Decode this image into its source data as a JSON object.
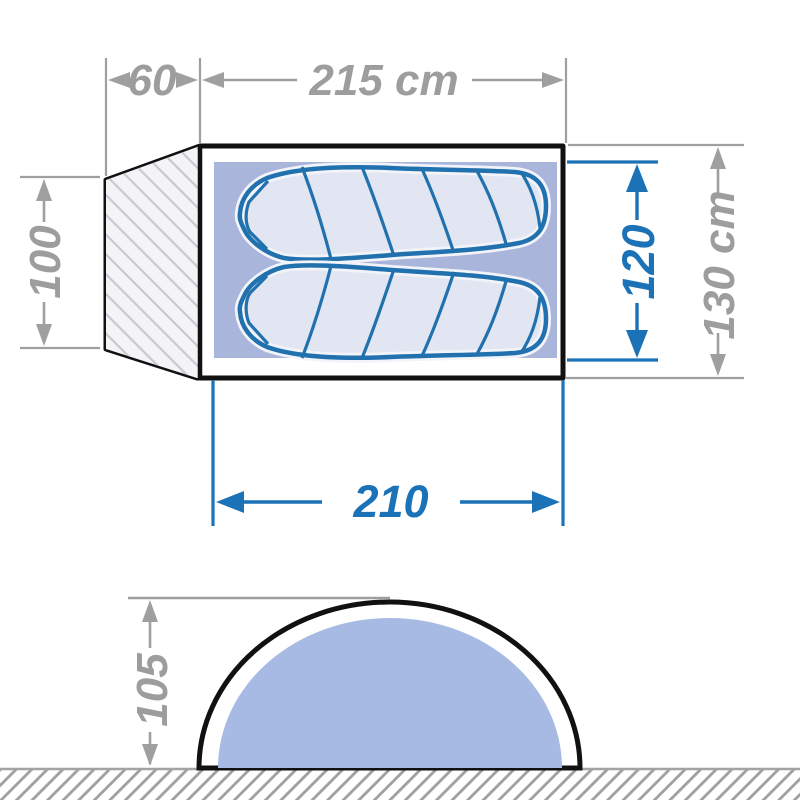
{
  "diagram": {
    "dimensions": {
      "porch_depth": {
        "label": "60"
      },
      "inner_length": {
        "label": "215 cm"
      },
      "porch_width": {
        "label": "100"
      },
      "inner_width": {
        "label": "120"
      },
      "outer_width": {
        "label": "130 cm"
      },
      "bedroom_length": {
        "label": "210"
      },
      "height": {
        "label": "105"
      }
    },
    "colors": {
      "dimension_gray": "#9d9d9d",
      "dimension_blue": "#1b72b6",
      "outline_black": "#111111",
      "groundsheet_fill": "#a9b5da",
      "sleeping_bag_fill": "#e2e6f2",
      "sleeping_bag_halo": "#f2f4fa",
      "sleeping_bag_outline": "#2171ae",
      "dome_fill": "#a6bae3",
      "vestibule_fill": "#f4f4f6",
      "vestibule_hatch": "#c6c9d1",
      "ground_hatch": "#9f9f9f"
    }
  }
}
